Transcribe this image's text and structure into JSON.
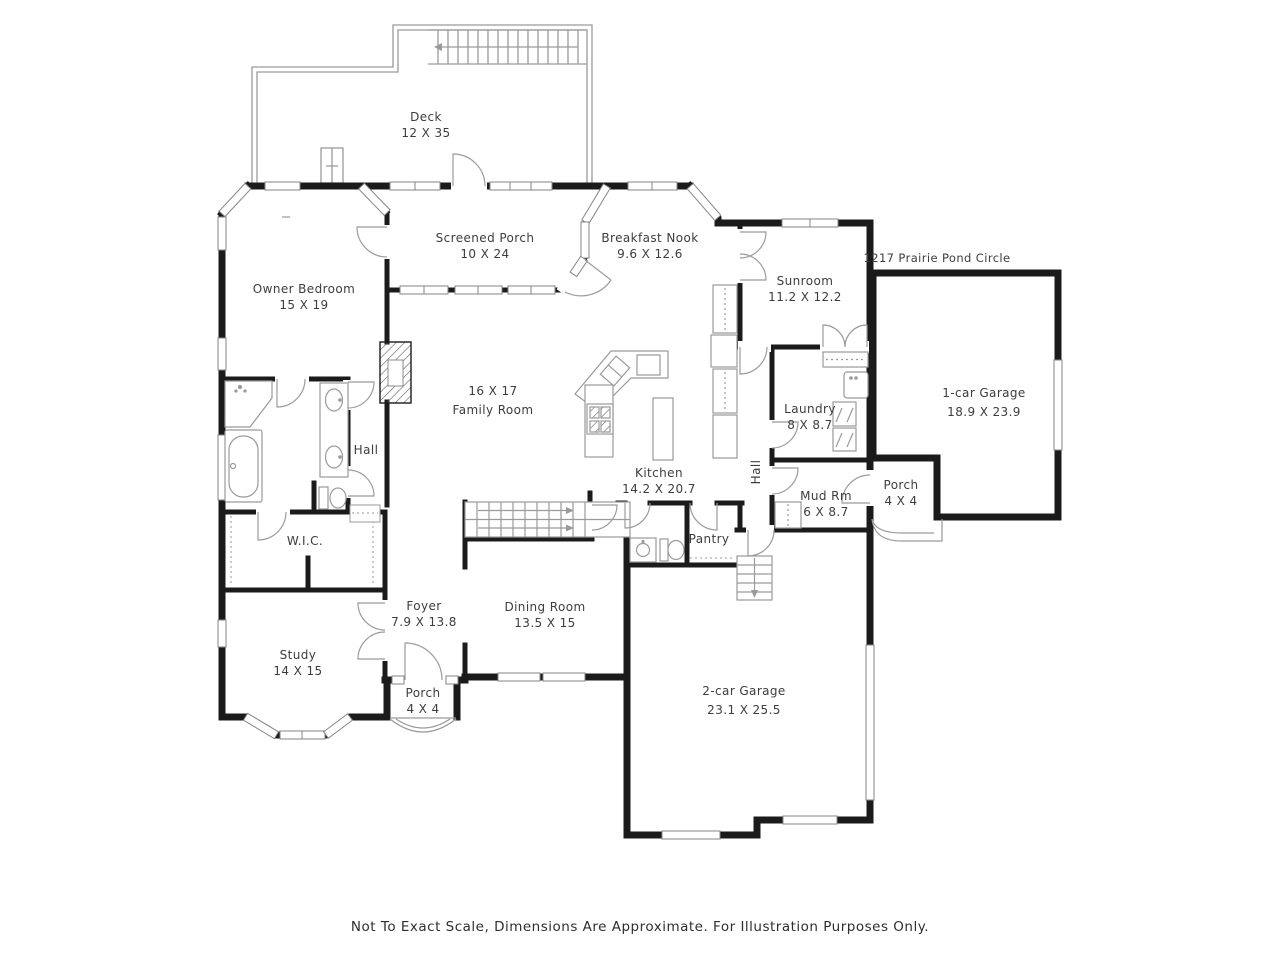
{
  "plan": {
    "address": "1217 Prairie Pond Circle",
    "disclaimer": "Not To Exact Scale, Dimensions Are Approximate. For Illustration Purposes Only.",
    "colors": {
      "wall": "#1b1b1b",
      "thin_line": "#9a9a9a",
      "text": "#3d3d3d",
      "background": "#ffffff"
    },
    "rooms": {
      "deck": {
        "line1": "Deck",
        "line2": "12 X 35"
      },
      "screened_porch": {
        "line1": "Screened Porch",
        "line2": "10 X 24"
      },
      "breakfast_nook": {
        "line1": "Breakfast Nook",
        "line2": "9.6 X 12.6"
      },
      "sunroom": {
        "line1": "Sunroom",
        "line2": "11.2 X 12.2"
      },
      "owner_bedroom": {
        "line1": "Owner Bedroom",
        "line2": "15 X 19"
      },
      "one_car_garage": {
        "line1": "1-car Garage",
        "line2": "18.9 X 23.9"
      },
      "family_room": {
        "line1": "16 X 17",
        "line2": "Family Room"
      },
      "laundry": {
        "line1": "Laundry",
        "line2": "8 X 8.7"
      },
      "hall_bath": {
        "line1": "Hall"
      },
      "kitchen": {
        "line1": "Kitchen",
        "line2": "14.2 X 20.7"
      },
      "hall_rear": {
        "line1": "Hall"
      },
      "mud_room": {
        "line1": "Mud Rm",
        "line2": "6 X 8.7"
      },
      "porch_rear": {
        "line1": "Porch",
        "line2": "4 X 4"
      },
      "wic": {
        "line1": "W.I.C."
      },
      "pantry": {
        "line1": "Pantry"
      },
      "foyer": {
        "line1": "Foyer",
        "line2": "7.9 X 13.8"
      },
      "dining_room": {
        "line1": "Dining Room",
        "line2": "13.5 X 15"
      },
      "study": {
        "line1": "Study",
        "line2": "14 X 15"
      },
      "porch_front": {
        "line1": "Porch",
        "line2": "4 X 4"
      },
      "two_car_garage": {
        "line1": "2-car Garage",
        "line2": "23.1 X 25.5"
      }
    }
  }
}
